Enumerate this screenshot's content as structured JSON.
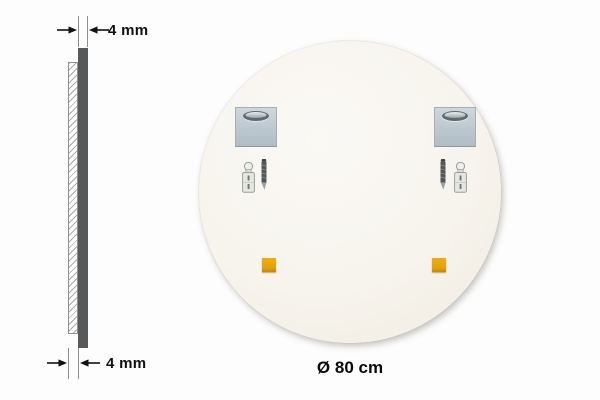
{
  "diagram": {
    "title_semantic": "round mirror back view with mounting hardware and thickness profile",
    "side_profile": {
      "top_dimension_label": "4 mm",
      "bottom_dimension_label": "4 mm"
    },
    "back_view": {
      "diameter_label": "Ø 80 cm"
    },
    "icons": [
      "dimension-arrow-icon",
      "mounting-plate-icon",
      "keyhole-slot-icon",
      "wall-plug-icon",
      "screw-icon",
      "adhesive-pad-icon"
    ],
    "colors": {
      "glass_edge_bar": "#58595b",
      "mirror_back_fill": "#f6f3ec",
      "mounting_plate": "#bfcad1",
      "keyhole_slot": "#5e6a72",
      "adhesive_pad": "#e4a00e",
      "annotation_text": "#111111"
    }
  }
}
